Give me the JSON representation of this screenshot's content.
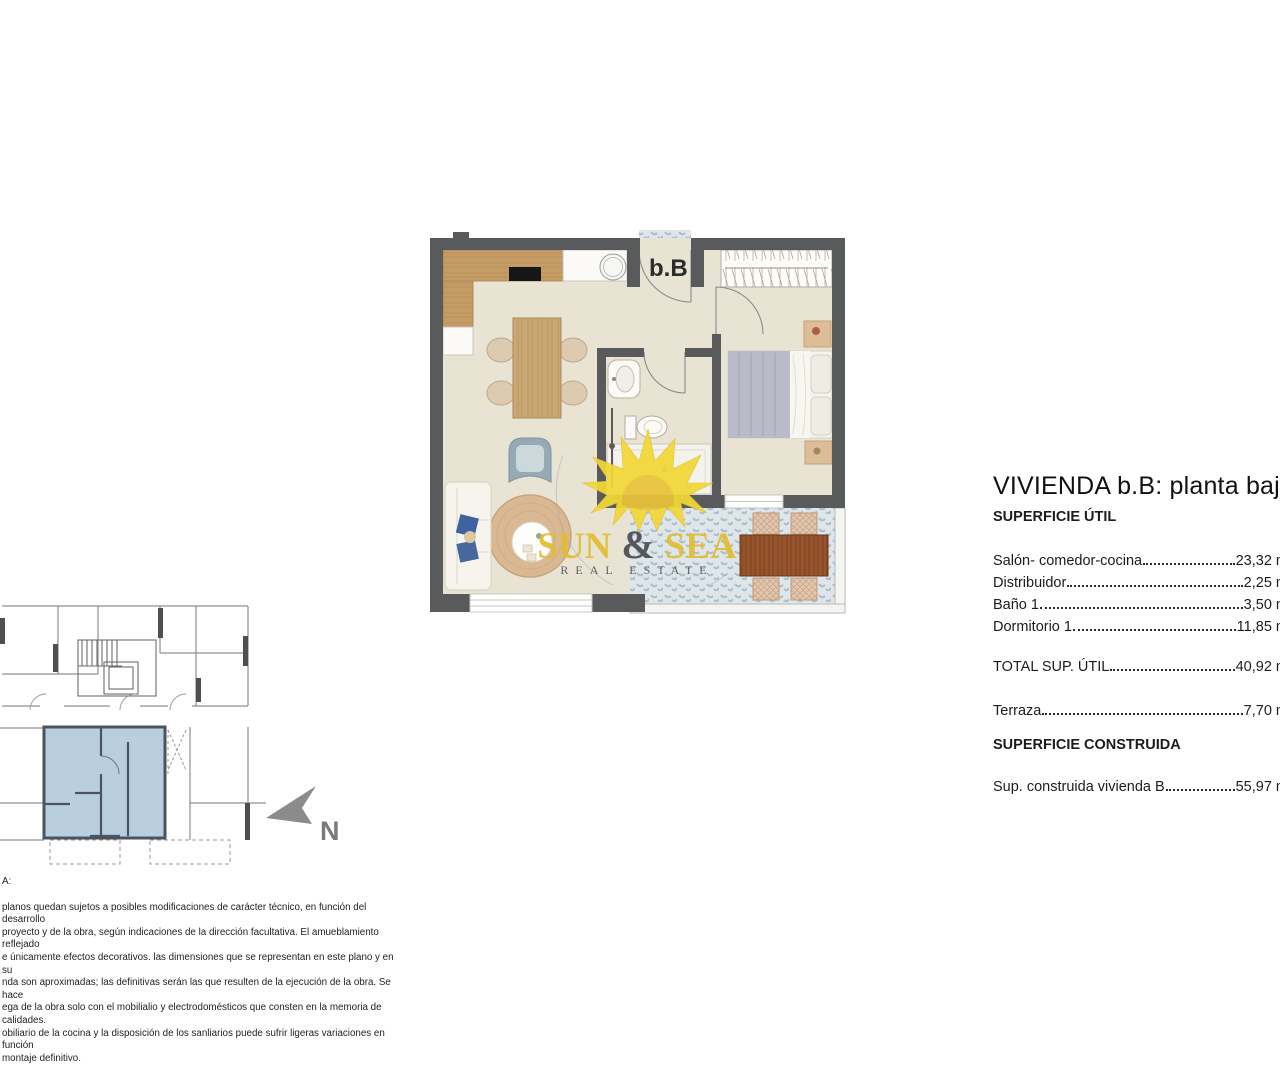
{
  "main_plan": {
    "unit_label": "b.B"
  },
  "north": {
    "label": "N"
  },
  "watermark": {
    "brand_sun": "SUN",
    "brand_amp": " & ",
    "brand_sea": "SEA",
    "tagline": "REAL ESTATE"
  },
  "details": {
    "title": "VIVIENDA b.B: planta baj",
    "useful_heading": "SUPERFICIE ÚTIL",
    "rooms": [
      {
        "label": "Salón- comedor-cocina",
        "value": "23,32 m"
      },
      {
        "label": "Distribuidor",
        "value": "2,25 m"
      },
      {
        "label": "Baño 1",
        "value": "3,50 m"
      },
      {
        "label": "Dormitorio 1",
        "value": "11,85 m"
      }
    ],
    "total": {
      "label": "TOTAL SUP. ÚTIL",
      "value": "40,92 m"
    },
    "terraza": {
      "label": "Terraza",
      "value": "7,70 m"
    },
    "built_heading": "SUPERFICIE CONSTRUIDA",
    "built": {
      "label": "Sup. construida vivienda B",
      "value": "55,97 m"
    }
  },
  "disclaimer": {
    "heading": "A:",
    "lines": [
      "planos quedan sujetos a posibles modificaciones de carácter técnico, en función del desarrollo",
      "proyecto y de la obra, según indicaciones de la dirección facultativa. El amueblamiento reflejado",
      "e únicamente efectos decorativos. las dimensiones que se representan en este plano y en su",
      "nda son aproximadas; las definitivas serán las que resulten de la ejecución de la obra. Se hace",
      "ega de la obra solo con el mobilialio y electrodomésticos que consten en la memoria de calidades.",
      "obiliario de la cocina y la disposición de los sanliarios puede sufrir ligeras variaciones en función",
      "montaje definitivo."
    ]
  },
  "colors": {
    "wall": "#595a5c",
    "floor": "#e8e3d3",
    "highlight_unit": "#b9cfe0",
    "terrace_tile": "#aabfca",
    "watermark_yellow": "#e2bd35",
    "watermark_dark": "#4d4d55"
  }
}
